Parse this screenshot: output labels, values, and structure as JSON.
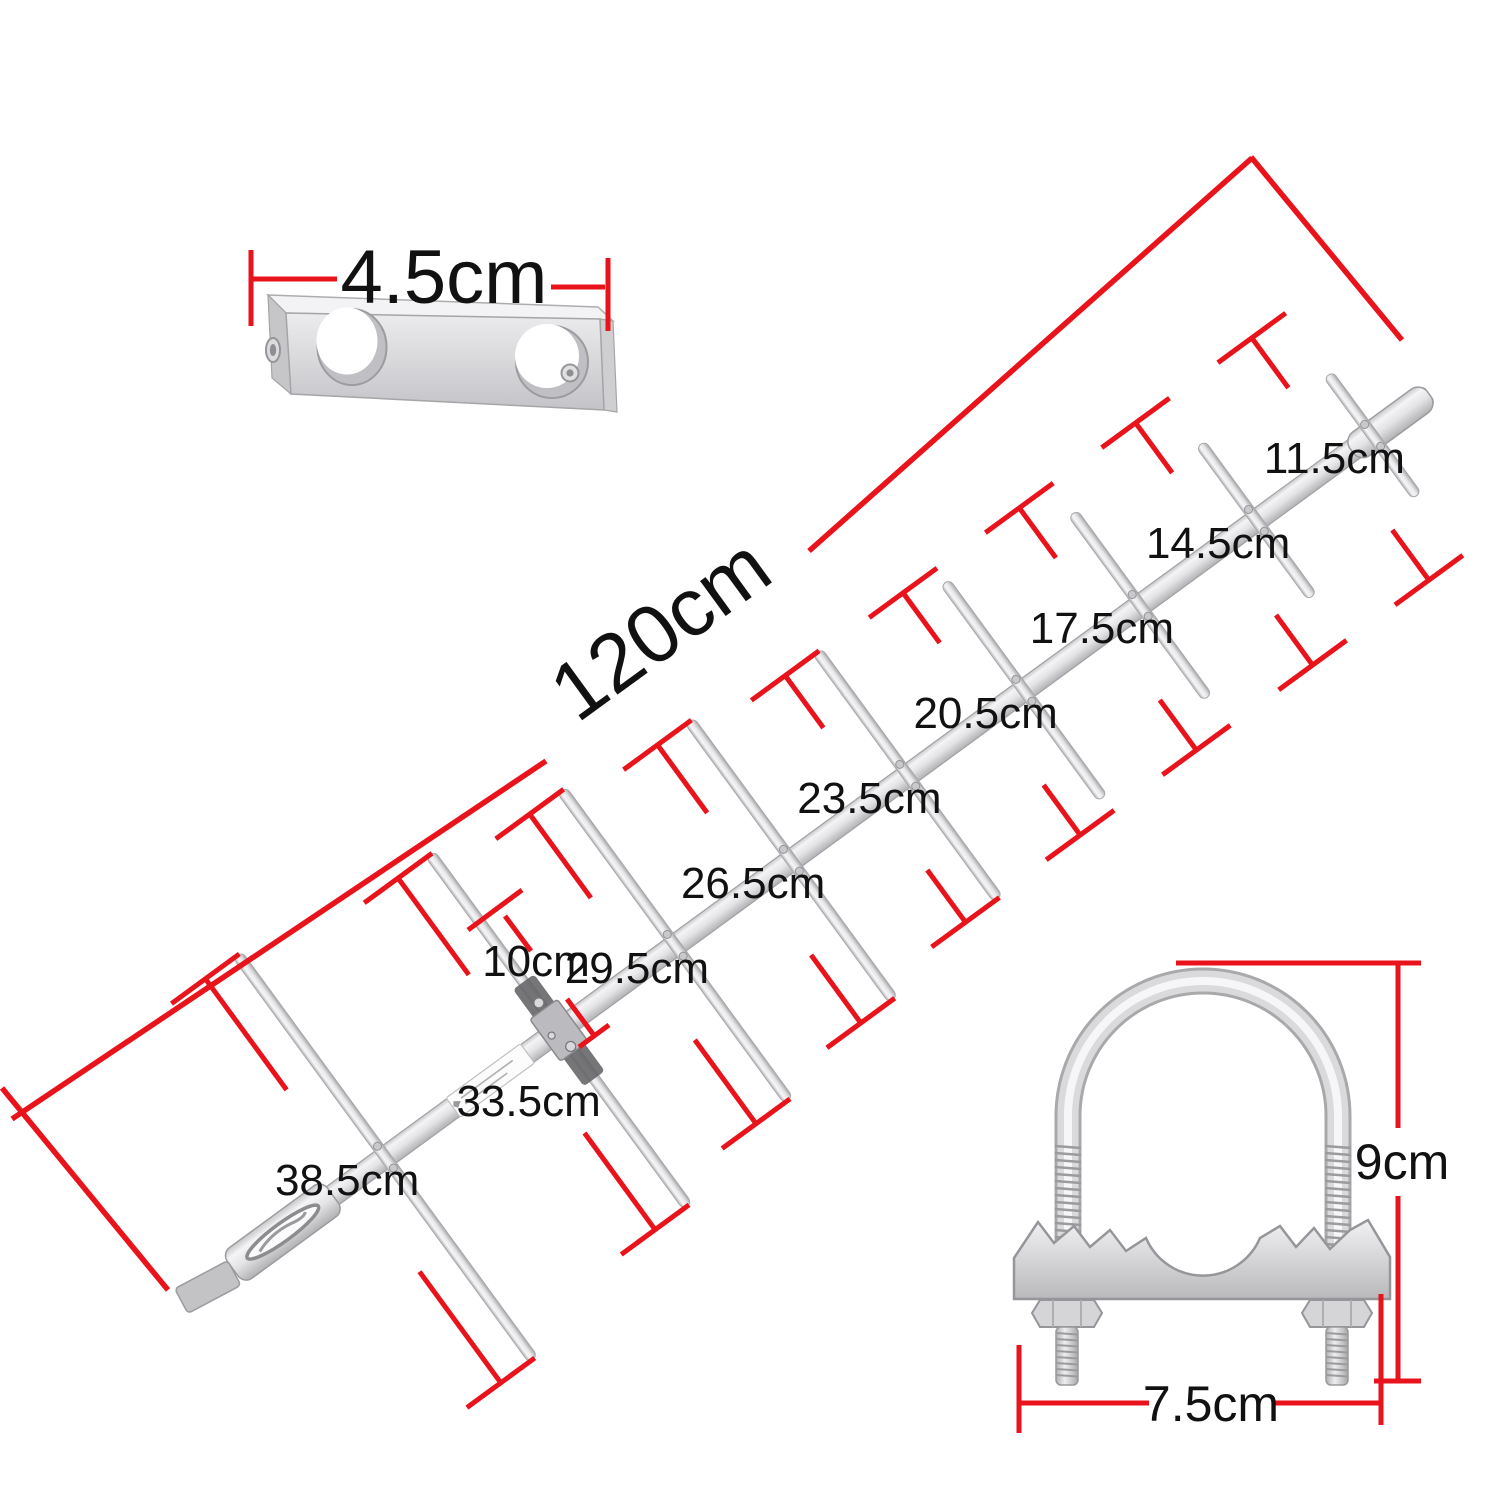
{
  "diagram": {
    "type": "product-dimension-diagram",
    "product": "yagi-antenna-kit",
    "spacer_block": {
      "width_label": "4.5cm",
      "width_cm": 4.5
    },
    "antenna": {
      "boom_label": "120cm",
      "boom_length_cm": 120,
      "spacing_label": "10cm",
      "spacing_cm": 10,
      "elements": [
        {
          "label": "38.5cm",
          "length_cm": 38.5
        },
        {
          "label": "33.5cm",
          "length_cm": 33.5
        },
        {
          "label": "29.5cm",
          "length_cm": 29.5
        },
        {
          "label": "26.5cm",
          "length_cm": 26.5
        },
        {
          "label": "23.5cm",
          "length_cm": 23.5
        },
        {
          "label": "20.5cm",
          "length_cm": 20.5
        },
        {
          "label": "17.5cm",
          "length_cm": 17.5
        },
        {
          "label": "14.5cm",
          "length_cm": 14.5
        },
        {
          "label": "11.5cm",
          "length_cm": 11.5
        }
      ]
    },
    "u_bolt_clamp": {
      "height_label": "9cm",
      "height_cm": 9,
      "width_label": "7.5cm",
      "width_cm": 7.5
    },
    "colors": {
      "dimension_line": "#e8131b",
      "label_text": "#111111",
      "metal_light": "#f4f4f6",
      "metal_mid": "#dddde0",
      "metal_dark": "#b2b2b5",
      "background": "#ffffff"
    }
  }
}
